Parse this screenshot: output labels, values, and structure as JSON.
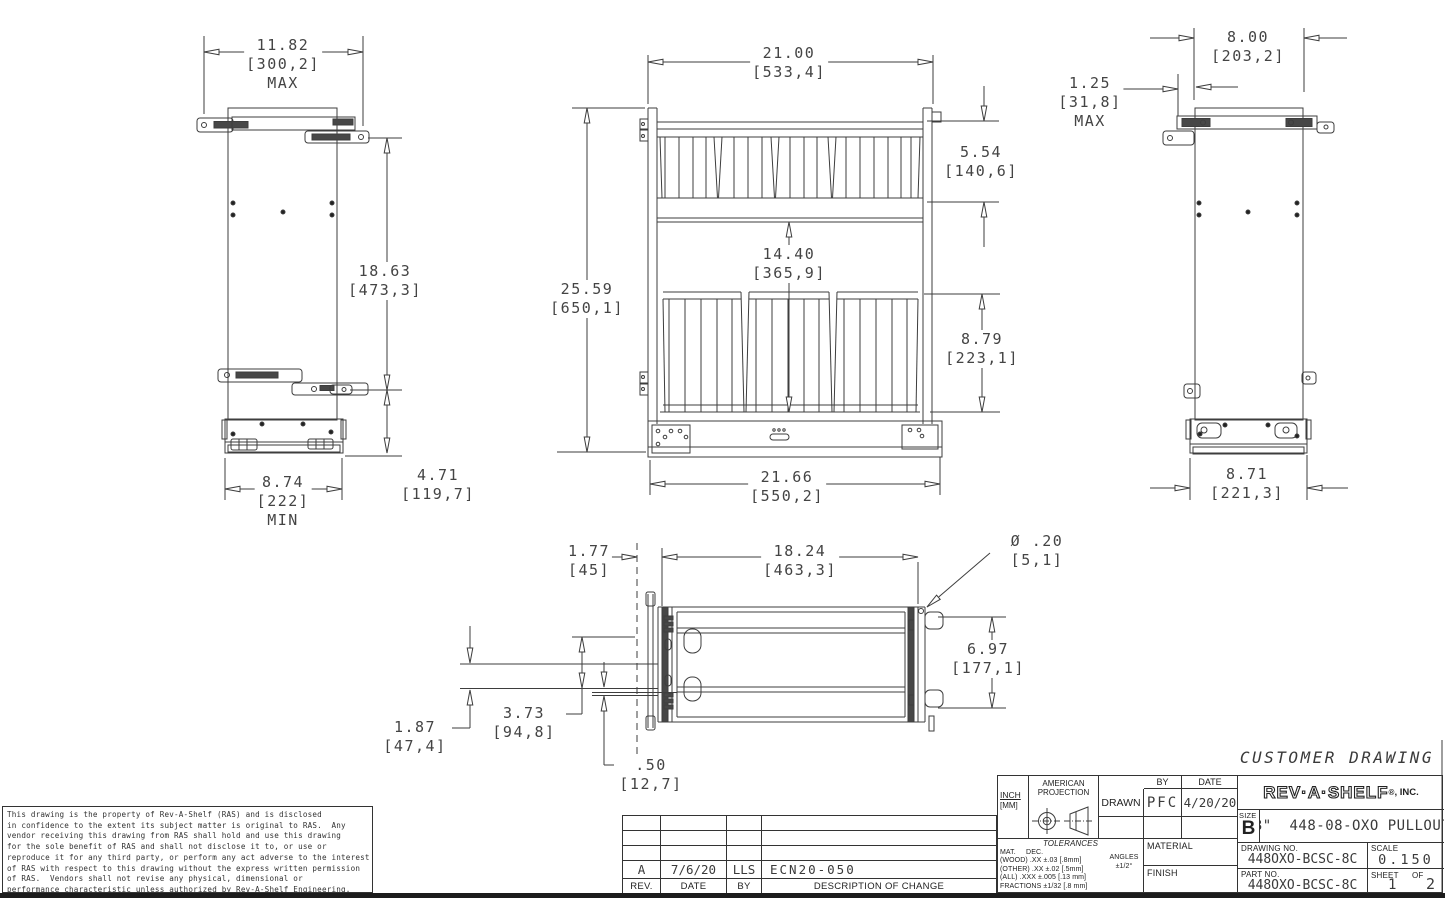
{
  "sheet": {
    "label": "CUSTOMER DRAWING"
  },
  "dims": {
    "top_width_max": {
      "v": "11.82",
      "mm": "[300,2]",
      "note": "MAX"
    },
    "side_height_upper": {
      "v": "18.63",
      "mm": "[473,3]",
      "note": ""
    },
    "depth_min": {
      "v": "8.74",
      "mm": "[222]",
      "note": "MIN"
    },
    "side_height_lower": {
      "v": "4.71",
      "mm": "[119,7]",
      "note": ""
    },
    "front_width_top": {
      "v": "21.00",
      "mm": "[533,4]",
      "note": ""
    },
    "front_height": {
      "v": "25.59",
      "mm": "[650,1]",
      "note": ""
    },
    "basket_top_height": {
      "v": "5.54",
      "mm": "[140,6]",
      "note": ""
    },
    "mid_height": {
      "v": "14.40",
      "mm": "[365,9]",
      "note": ""
    },
    "basket_low_height": {
      "v": "8.79",
      "mm": "[223,1]",
      "note": ""
    },
    "front_width_bottom": {
      "v": "21.66",
      "mm": "[550,2]",
      "note": ""
    },
    "right_width": {
      "v": "8.00",
      "mm": "[203,2]",
      "note": ""
    },
    "rear_offset_max": {
      "v": "1.25",
      "mm": "[31,8]",
      "note": "MAX"
    },
    "right_depth_bottom": {
      "v": "8.71",
      "mm": "[221,3]",
      "note": ""
    },
    "plan_offset_front": {
      "v": "1.77",
      "mm": "[45]",
      "note": ""
    },
    "plan_width": {
      "v": "18.24",
      "mm": "[463,3]",
      "note": ""
    },
    "hole_dia": {
      "v": "Ø .20",
      "mm": "[5,1]",
      "note": ""
    },
    "plan_depth": {
      "v": "6.97",
      "mm": "[177,1]",
      "note": ""
    },
    "slide_width": {
      "v": "1.87",
      "mm": "[47,4]",
      "note": ""
    },
    "slide_offset": {
      "v": "3.73",
      "mm": "[94,8]",
      "note": ""
    },
    "half_offset": {
      "v": ".50",
      "mm": "[12,7]",
      "note": ""
    }
  },
  "legal": {
    "lines": [
      "This drawing is the property of Rev-A-Shelf (RAS) and is disclosed",
      "in confidence to the extent its subject matter is original to RAS.  Any",
      "vendor receiving this drawing from RAS shall hold and use this drawing",
      "for the sole benefit of RAS and shall not disclose it to, or use or",
      "reproduce it for any third party, or perform any act adverse to the interest",
      "of RAS with respect to this drawing without the express written permission",
      "of RAS.  Vendors shall not revise any physical, dimensional or",
      "performance characteristic unless authorized by Rev-A-Shelf Engineering."
    ]
  },
  "rev_table": {
    "headers": {
      "rev": "REV.",
      "date": "DATE",
      "by": "BY",
      "desc": "DESCRIPTION OF CHANGE"
    },
    "rows": [
      {
        "rev": "A",
        "date": "7/6/20",
        "by": "LLS",
        "desc": "ECN20-050"
      }
    ]
  },
  "title_block": {
    "units_in": "INCH",
    "units_mm": "[MM]",
    "projection": "AMERICAN PROJECTION",
    "drawn_label": "DRAWN",
    "by_label": "BY",
    "date_label": "DATE",
    "drawn_by": "PFC",
    "drawn_date": "4/20/20",
    "logo": "REV·A·SHELF",
    "logo_reg": "®",
    "logo_inc": ", INC.",
    "size_label": "SIZE",
    "size": "B",
    "title": "8\"  448-08-OXO PULLOUT",
    "tol_title": "TOLERANCES",
    "tol_lines": [
      "MAT.     DEC.",
      "(WOOD) .XX ±.03 [.8mm]",
      "(OTHER) .XX ±.02 [.5mm]",
      "(ALL) .XXX ±.005 [.13 mm]",
      "FRACTIONS ±1/32 [.8 mm]"
    ],
    "angles_label": "ANGLES",
    "angles_value": "±1/2°",
    "material_label": "MATERIAL",
    "finish_label": "FINISH",
    "drawing_no_label": "DRAWING NO.",
    "drawing_no": "448OXO-BCSC-8C",
    "scale_label": "SCALE",
    "scale": "0.150",
    "part_no_label": "PART NO.",
    "part_no": "448OXO-BCSC-8C",
    "sheet_label": "SHEET",
    "of_label": "OF",
    "sheet_no": "1",
    "sheet_of": "2"
  }
}
